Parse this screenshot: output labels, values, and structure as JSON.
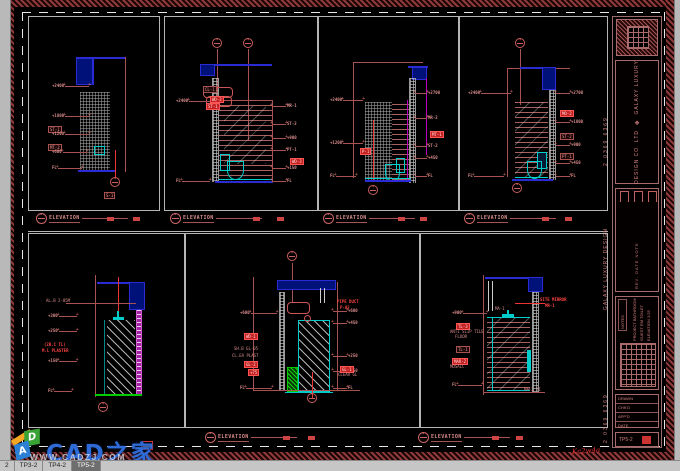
{
  "window": {
    "tabs": [
      {
        "label": "2",
        "active": false
      },
      {
        "label": "TP3-2",
        "active": false
      },
      {
        "label": "TP4-2",
        "active": false
      },
      {
        "label": "TP5-2",
        "active": true
      }
    ]
  },
  "watermark": {
    "brand": "CAD之家",
    "url": "WWW.CADZJ.COM",
    "cube_letters": [
      "A",
      "D"
    ]
  },
  "signature": "Kc2w4a",
  "elevation_label_text": "ELEVATION",
  "colors": {
    "dim_red": "#a85252",
    "bright_red": "#ff2222",
    "cad_blue": "#2b2bd4",
    "cad_cyan": "#00cccc",
    "cad_green": "#00cc00",
    "cad_magenta": "#bb00bb",
    "brand_blue": "#2f6bd8"
  },
  "title_block": {
    "side_digits_top": "2 0369 6369",
    "side_company": "GALAXY LUXURY DESIGN",
    "side_digits_bottom": "2 0369 6369",
    "brand_line1": "GALAXY LUXURY",
    "brand_line2": "DESIGN CO. LTD",
    "logo_glyph": "❖",
    "rev_lines": "REV.  DATE  NOTE",
    "info_header": "NOTES",
    "info_lines": [
      "PROJECT BATHROOM",
      "GUEST RM TOILET",
      "ELEVATION 1:25"
    ],
    "list_rows": [
      "DRAWN",
      "CHK'D",
      "APP'D",
      "DATE"
    ],
    "sheet_label": "DWG NO.",
    "sheet_no": "TP5-2"
  },
  "panels": [
    {
      "name": "elevation-1",
      "label": {
        "x": 36,
        "y": 213,
        "m": [
          107,
          133
        ]
      },
      "anno": [
        {
          "k": "d",
          "x": 52,
          "y": 86,
          "w": 24,
          "t": "+2400"
        },
        {
          "k": "d",
          "x": 52,
          "y": 116,
          "w": 24,
          "t": "+1800"
        },
        {
          "k": "g",
          "x": 48,
          "y": 126,
          "t": "ST-1"
        },
        {
          "k": "d",
          "x": 52,
          "y": 134,
          "w": 24,
          "t": "+1200"
        },
        {
          "k": "g",
          "x": 48,
          "y": 144,
          "t": "MT-2"
        },
        {
          "k": "d",
          "x": 52,
          "y": 152,
          "w": 24,
          "t": "+600"
        },
        {
          "k": "d",
          "x": 52,
          "y": 168,
          "w": 24,
          "t": "FL"
        },
        {
          "k": "c",
          "x": 110,
          "y": 177
        },
        {
          "k": "g",
          "x": 104,
          "y": 192,
          "t": "S-1"
        }
      ]
    },
    {
      "name": "elevation-2",
      "label": {
        "x": 170,
        "y": 213,
        "m": [
          253,
          277
        ]
      },
      "anno": [
        {
          "k": "c",
          "x": 212,
          "y": 38
        },
        {
          "k": "c",
          "x": 243,
          "y": 38
        },
        {
          "k": "d",
          "x": 176,
          "y": 101,
          "w": 28,
          "t": "+2400"
        },
        {
          "k": "g",
          "x": 203,
          "y": 86,
          "t": "CL-1"
        },
        {
          "k": "G",
          "x": 210,
          "y": 96,
          "t": "WD-2"
        },
        {
          "k": "G",
          "x": 206,
          "y": 103,
          "t": "ST-1"
        },
        {
          "k": "r",
          "x": 272,
          "y": 106,
          "w": 14,
          "t": "MR-1"
        },
        {
          "k": "r",
          "x": 272,
          "y": 124,
          "w": 14,
          "t": "ST-2"
        },
        {
          "k": "r",
          "x": 272,
          "y": 138,
          "w": 14,
          "t": "+900"
        },
        {
          "k": "r",
          "x": 272,
          "y": 150,
          "w": 14,
          "t": "PT-1"
        },
        {
          "k": "G",
          "x": 290,
          "y": 158,
          "t": "WD-3"
        },
        {
          "k": "r",
          "x": 272,
          "y": 168,
          "w": 14,
          "t": "+150"
        },
        {
          "k": "r",
          "x": 272,
          "y": 181,
          "w": 14,
          "t": "FL"
        },
        {
          "k": "d",
          "x": 176,
          "y": 181,
          "w": 28,
          "t": "FL"
        }
      ]
    },
    {
      "name": "elevation-3",
      "label": {
        "x": 323,
        "y": 213,
        "m": [
          398,
          420
        ]
      },
      "anno": [
        {
          "k": "d",
          "x": 330,
          "y": 100,
          "w": 20,
          "t": "+2400"
        },
        {
          "k": "d",
          "x": 330,
          "y": 143,
          "w": 20,
          "t": "+1200"
        },
        {
          "k": "d",
          "x": 330,
          "y": 176,
          "w": 20,
          "t": "FL"
        },
        {
          "k": "r",
          "x": 415,
          "y": 93,
          "w": 12,
          "t": "+2700"
        },
        {
          "k": "r",
          "x": 415,
          "y": 118,
          "w": 12,
          "t": "MR-2"
        },
        {
          "k": "G",
          "x": 430,
          "y": 131,
          "t": "MT-1"
        },
        {
          "k": "r",
          "x": 415,
          "y": 146,
          "w": 12,
          "t": "ST-2"
        },
        {
          "k": "r",
          "x": 415,
          "y": 158,
          "w": 12,
          "t": "+450"
        },
        {
          "k": "r",
          "x": 415,
          "y": 176,
          "w": 12,
          "t": "FL"
        },
        {
          "k": "G",
          "x": 360,
          "y": 148,
          "t": "P-1"
        },
        {
          "k": "c",
          "x": 368,
          "y": 185
        }
      ]
    },
    {
      "name": "elevation-4",
      "label": {
        "x": 464,
        "y": 213,
        "m": [
          542,
          565
        ]
      },
      "anno": [
        {
          "k": "c",
          "x": 515,
          "y": 38
        },
        {
          "k": "c",
          "x": 512,
          "y": 183
        },
        {
          "k": "d",
          "x": 468,
          "y": 93,
          "w": 30,
          "t": "+2400"
        },
        {
          "k": "d",
          "x": 468,
          "y": 176,
          "w": 30,
          "t": "FL"
        },
        {
          "k": "r",
          "x": 556,
          "y": 93,
          "w": 14,
          "t": "+2700"
        },
        {
          "k": "G",
          "x": 560,
          "y": 110,
          "t": "MO-2"
        },
        {
          "k": "r",
          "x": 556,
          "y": 122,
          "w": 14,
          "t": "+1800"
        },
        {
          "k": "g",
          "x": 560,
          "y": 133,
          "t": "ST-2"
        },
        {
          "k": "r",
          "x": 556,
          "y": 145,
          "w": 14,
          "t": "+900"
        },
        {
          "k": "g",
          "x": 560,
          "y": 153,
          "t": "PT-1"
        },
        {
          "k": "r",
          "x": 556,
          "y": 163,
          "w": 14,
          "t": "+450"
        },
        {
          "k": "r",
          "x": 556,
          "y": 176,
          "w": 14,
          "t": "FL"
        }
      ]
    },
    {
      "name": "section-5",
      "anno": [
        {
          "k": "t",
          "x": 46,
          "y": 299,
          "t": "AL.B 2-05M"
        },
        {
          "k": "d",
          "x": 48,
          "y": 316,
          "w": 18,
          "t": "+300"
        },
        {
          "k": "d",
          "x": 48,
          "y": 331,
          "w": 18,
          "t": "+250"
        },
        {
          "k": "T",
          "x": 44,
          "y": 343,
          "t": "(2B.C TL)"
        },
        {
          "k": "T",
          "x": 42,
          "y": 349,
          "t": "M.L PLASTER"
        },
        {
          "k": "d",
          "x": 48,
          "y": 361,
          "w": 18,
          "t": "+150"
        },
        {
          "k": "d",
          "x": 48,
          "y": 391,
          "w": 18,
          "t": "FL"
        },
        {
          "k": "c",
          "x": 98,
          "y": 402
        }
      ]
    },
    {
      "name": "section-6",
      "label": {
        "x": 205,
        "y": 432,
        "m": [
          283,
          308
        ]
      },
      "anno": [
        {
          "k": "c",
          "x": 287,
          "y": 251
        },
        {
          "k": "T",
          "x": 337,
          "y": 300,
          "t": "PIPE DUCT"
        },
        {
          "k": "T",
          "x": 340,
          "y": 306,
          "t": "P-02"
        },
        {
          "k": "d",
          "x": 240,
          "y": 313,
          "w": 26,
          "t": "+600"
        },
        {
          "k": "G",
          "x": 244,
          "y": 333,
          "t": "WD-1"
        },
        {
          "k": "t",
          "x": 234,
          "y": 347,
          "t": "SH.B GL-05"
        },
        {
          "k": "t",
          "x": 232,
          "y": 354,
          "t": "CL.EA PLAST"
        },
        {
          "k": "G",
          "x": 244,
          "y": 361,
          "t": "GL-2"
        },
        {
          "k": "G",
          "x": 248,
          "y": 369,
          "t": "+75"
        },
        {
          "k": "d",
          "x": 240,
          "y": 388,
          "w": 26,
          "t": "FL"
        },
        {
          "k": "r",
          "x": 333,
          "y": 311,
          "w": 14,
          "t": "+600"
        },
        {
          "k": "r",
          "x": 333,
          "y": 323,
          "w": 14,
          "t": "+450"
        },
        {
          "k": "r",
          "x": 333,
          "y": 356,
          "w": 14,
          "t": "+250"
        },
        {
          "k": "r",
          "x": 333,
          "y": 371,
          "w": 14,
          "t": "+150"
        },
        {
          "k": "r",
          "x": 333,
          "y": 388,
          "w": 14,
          "t": "FL"
        },
        {
          "k": "G",
          "x": 340,
          "y": 366,
          "t": "GL-1"
        },
        {
          "k": "t",
          "x": 338,
          "y": 373,
          "t": "CLEAR GL"
        },
        {
          "k": "c",
          "x": 307,
          "y": 393
        }
      ]
    },
    {
      "name": "elevation-7",
      "label": {
        "x": 418,
        "y": 432,
        "m": [
          492,
          516
        ]
      },
      "anno": [
        {
          "k": "d",
          "x": 452,
          "y": 313,
          "w": 24,
          "t": "+900"
        },
        {
          "k": "G",
          "x": 456,
          "y": 323,
          "t": "TL-3"
        },
        {
          "k": "t",
          "x": 450,
          "y": 330,
          "t": "ANTI SLIP TILE"
        },
        {
          "k": "t",
          "x": 455,
          "y": 335,
          "t": "FLOOR"
        },
        {
          "k": "g",
          "x": 456,
          "y": 346,
          "t": "TL-1"
        },
        {
          "k": "G",
          "x": 452,
          "y": 358,
          "t": "MAR-2"
        },
        {
          "k": "t",
          "x": 450,
          "y": 365,
          "t": "MOSAIC"
        },
        {
          "k": "d",
          "x": 452,
          "y": 385,
          "w": 24,
          "t": "FL"
        },
        {
          "k": "t",
          "x": 495,
          "y": 307,
          "t": "MA-1"
        },
        {
          "k": "T",
          "x": 540,
          "y": 298,
          "t": "SITE MIRROR"
        },
        {
          "k": "T",
          "x": 545,
          "y": 304,
          "t": "MR-1"
        },
        {
          "k": "t",
          "x": 524,
          "y": 388,
          "t": "MA-2 TI"
        }
      ]
    }
  ]
}
